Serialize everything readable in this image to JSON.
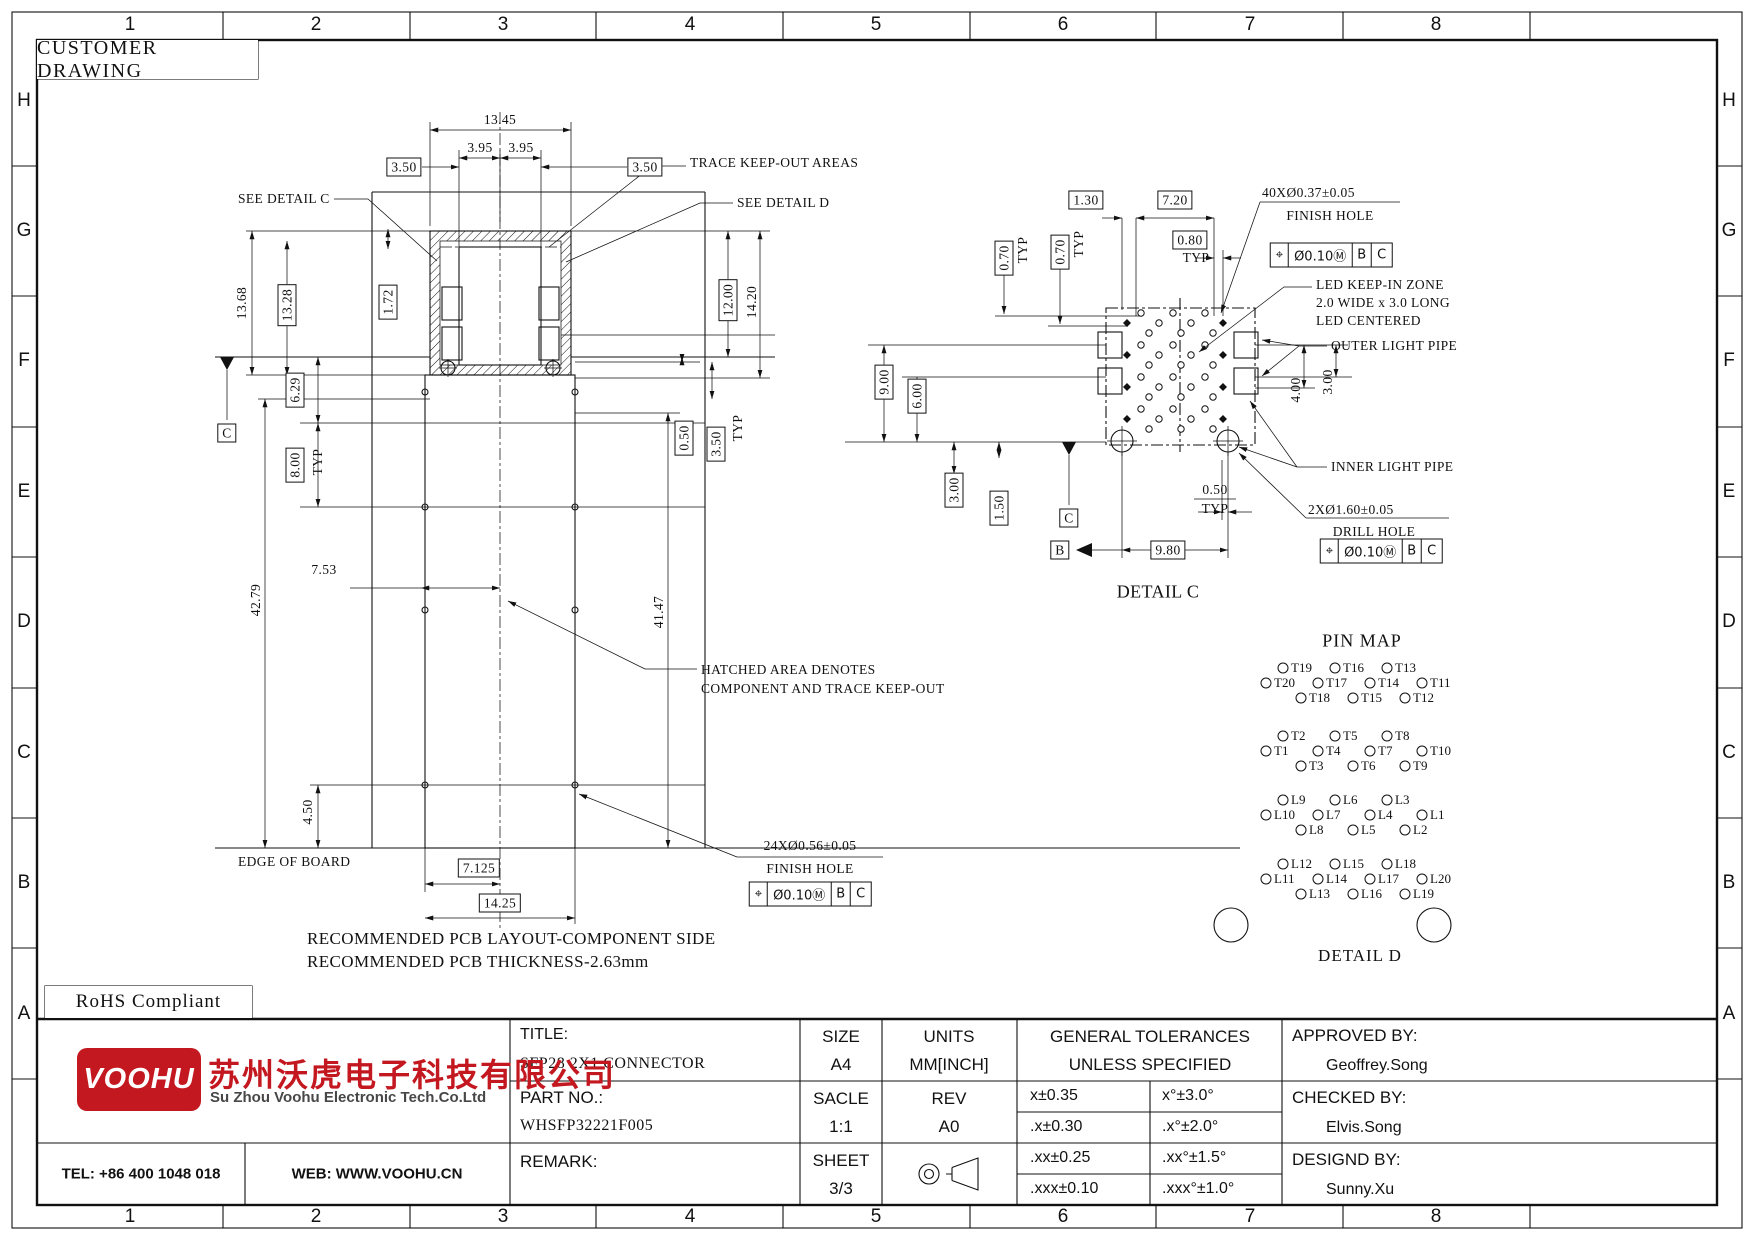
{
  "boxes": {
    "customer_drawing": "CUSTOMER DRAWING",
    "rohs": "RoHS Compliant"
  },
  "border": {
    "columns": [
      "1",
      "2",
      "3",
      "4",
      "5",
      "6",
      "7",
      "8"
    ],
    "rows": [
      "H",
      "G",
      "F",
      "E",
      "D",
      "C",
      "B",
      "A"
    ]
  },
  "pin_map": {
    "title": "PIN MAP",
    "detail_label": "DETAIL D",
    "groups": [
      {
        "rows": [
          [
            "T19",
            "T16",
            "T13"
          ],
          [
            "T20",
            "T17",
            "T14",
            "T11"
          ],
          [
            "T18",
            "T15",
            "T12"
          ]
        ]
      },
      {
        "rows": [
          [
            "T2",
            "T5",
            "T8"
          ],
          [
            "T1",
            "T4",
            "T7",
            "T10"
          ],
          [
            "T3",
            "T6",
            "T9"
          ]
        ]
      },
      {
        "rows": [
          [
            "L9",
            "L6",
            "L3"
          ],
          [
            "L10",
            "L7",
            "L4",
            "L1"
          ],
          [
            "L8",
            "L5",
            "L2"
          ]
        ]
      },
      {
        "rows": [
          [
            "L12",
            "L15",
            "L18"
          ],
          [
            "L11",
            "L14",
            "L17",
            "L20"
          ],
          [
            "L13",
            "L16",
            "L19"
          ]
        ]
      }
    ]
  },
  "gdt_frames": [
    {
      "x": 810,
      "y": 894,
      "cells": [
        "⌖",
        "Ø0.10Ⓜ",
        "B",
        "C"
      ]
    },
    {
      "x": 1331,
      "y": 255,
      "cells": [
        "⌖",
        "Ø0.10Ⓜ",
        "B",
        "C"
      ]
    },
    {
      "x": 1381,
      "y": 551,
      "cells": [
        "⌖",
        "Ø0.10Ⓜ",
        "B",
        "C"
      ]
    }
  ],
  "annotations": [
    {
      "t": "13.45",
      "x": 500,
      "y": 120
    },
    {
      "t": "3.95",
      "x": 480,
      "y": 148
    },
    {
      "t": "3.95",
      "x": 521,
      "y": 148
    },
    {
      "t": "3.50",
      "x": 404,
      "y": 167,
      "box": 1
    },
    {
      "t": "3.50",
      "x": 645,
      "y": 167,
      "box": 1
    },
    {
      "t": "TRACE KEEP-OUT AREAS",
      "x": 690,
      "y": 163,
      "al": 1,
      "n": "note-trace-keepout"
    },
    {
      "t": "SEE DETAIL C",
      "x": 238,
      "y": 199,
      "al": 1,
      "n": "note-see-detail-c"
    },
    {
      "t": "SEE DETAIL D",
      "x": 737,
      "y": 203,
      "al": 1,
      "n": "note-see-detail-d"
    },
    {
      "t": "13.68",
      "x": 242,
      "y": 303,
      "rot": 1
    },
    {
      "t": "13.28",
      "x": 287,
      "y": 305,
      "rot": 1,
      "box": 1
    },
    {
      "t": "1.72",
      "x": 388,
      "y": 302,
      "rot": 1,
      "box": 1
    },
    {
      "t": "12.00",
      "x": 728,
      "y": 300,
      "rot": 1,
      "box": 1
    },
    {
      "t": "14.20",
      "x": 752,
      "y": 302,
      "rot": 1
    },
    {
      "t": "6.29",
      "x": 295,
      "y": 390,
      "rot": 1,
      "box": 1
    },
    {
      "t": "8.00",
      "x": 295,
      "y": 465,
      "rot": 1,
      "box": 1
    },
    {
      "t": "TYP",
      "x": 318,
      "y": 462,
      "rot": 1
    },
    {
      "t": "0.50",
      "x": 684,
      "y": 438,
      "rot": 1,
      "box": 1
    },
    {
      "t": "3.50",
      "x": 716,
      "y": 444,
      "rot": 1,
      "box": 1
    },
    {
      "t": "TYP",
      "x": 738,
      "y": 428,
      "rot": 1
    },
    {
      "t": "42.79",
      "x": 256,
      "y": 600,
      "rot": 1
    },
    {
      "t": "7.53",
      "x": 324,
      "y": 570
    },
    {
      "t": "41.47",
      "x": 659,
      "y": 612,
      "rot": 1
    },
    {
      "t": "4.50",
      "x": 308,
      "y": 812,
      "rot": 1
    },
    {
      "t": "EDGE OF BOARD",
      "x": 238,
      "y": 862,
      "al": 1,
      "n": "note-edge-of-board"
    },
    {
      "t": "7.125",
      "x": 479,
      "y": 868,
      "box": 1
    },
    {
      "t": "14.25",
      "x": 500,
      "y": 903,
      "box": 1
    },
    {
      "t": "HATCHED AREA DENOTES",
      "x": 701,
      "y": 670,
      "al": 1,
      "n": "note-hatched-area"
    },
    {
      "t": "COMPONENT AND TRACE KEEP-OUT",
      "x": 701,
      "y": 689,
      "al": 1
    },
    {
      "t": "24XØ0.56±0.05",
      "x": 810,
      "y": 846,
      "n": "callout-finish-hole-24x"
    },
    {
      "t": "FINISH HOLE",
      "x": 810,
      "y": 869
    },
    {
      "t": "RECOMMENDED PCB LAYOUT-COMPONENT SIDE",
      "x": 307,
      "y": 939,
      "al": 1,
      "fs": 17,
      "n": "note-pcb-layout"
    },
    {
      "t": "RECOMMENDED PCB THICKNESS-2.63mm",
      "x": 307,
      "y": 962,
      "al": 1,
      "fs": 17,
      "n": "note-pcb-thickness"
    },
    {
      "t": "C",
      "x": 227,
      "y": 433,
      "box": 1,
      "n": "datum-c"
    },
    {
      "t": "1.30",
      "x": 1086,
      "y": 200,
      "box": 1
    },
    {
      "t": "7.20",
      "x": 1175,
      "y": 200,
      "box": 1
    },
    {
      "t": "0.80",
      "x": 1190,
      "y": 240,
      "box": 1
    },
    {
      "t": "TYP",
      "x": 1196,
      "y": 258
    },
    {
      "t": "0.70",
      "x": 1004,
      "y": 258,
      "rot": 1,
      "box": 1
    },
    {
      "t": "TYP",
      "x": 1023,
      "y": 250,
      "rot": 1
    },
    {
      "t": "0.70",
      "x": 1060,
      "y": 252,
      "rot": 1,
      "box": 1
    },
    {
      "t": "TYP",
      "x": 1079,
      "y": 244,
      "rot": 1
    },
    {
      "t": "40XØ0.37±0.05",
      "x": 1262,
      "y": 193,
      "al": 1,
      "n": "callout-finish-hole-40x"
    },
    {
      "t": "FINISH HOLE",
      "x": 1330,
      "y": 216
    },
    {
      "t": "LED KEEP-IN ZONE",
      "x": 1316,
      "y": 285,
      "al": 1,
      "n": "note-led-keepin"
    },
    {
      "t": "2.0 WIDE x 3.0 LONG",
      "x": 1316,
      "y": 303,
      "al": 1
    },
    {
      "t": "LED CENTERED",
      "x": 1316,
      "y": 321,
      "al": 1
    },
    {
      "t": "OUTER LIGHT PIPE",
      "x": 1331,
      "y": 346,
      "al": 1,
      "n": "note-outer-light-pipe"
    },
    {
      "t": "9.00",
      "x": 884,
      "y": 382,
      "rot": 1,
      "box": 1
    },
    {
      "t": "6.00",
      "x": 917,
      "y": 396,
      "rot": 1,
      "box": 1
    },
    {
      "t": "4.00",
      "x": 1296,
      "y": 390,
      "rot": 1
    },
    {
      "t": "3.00",
      "x": 1328,
      "y": 382,
      "rot": 1
    },
    {
      "t": "3.00",
      "x": 954,
      "y": 490,
      "rot": 1,
      "box": 1
    },
    {
      "t": "1.50",
      "x": 999,
      "y": 508,
      "rot": 1,
      "box": 1
    },
    {
      "t": "C",
      "x": 1069,
      "y": 518,
      "box": 1,
      "n": "datum-c-detail"
    },
    {
      "t": "B",
      "x": 1060,
      "y": 550,
      "box": 1,
      "n": "datum-b"
    },
    {
      "t": "9.80",
      "x": 1168,
      "y": 550,
      "box": 1
    },
    {
      "t": "0.50",
      "x": 1215,
      "y": 490
    },
    {
      "t": "TYP",
      "x": 1215,
      "y": 509
    },
    {
      "t": "INNER LIGHT PIPE",
      "x": 1331,
      "y": 467,
      "al": 1,
      "n": "note-inner-light-pipe"
    },
    {
      "t": "2XØ1.60±0.05",
      "x": 1308,
      "y": 510,
      "al": 1,
      "n": "callout-drill-hole-2x"
    },
    {
      "t": "DRILL HOLE",
      "x": 1374,
      "y": 532
    },
    {
      "t": "DETAIL C",
      "x": 1158,
      "y": 592,
      "fs": 18,
      "n": "detail-c-label"
    }
  ],
  "title_block": {
    "title_label": "TITLE:",
    "title": "SFP28 2X1 CONNECTOR",
    "size_label": "SIZE",
    "size": "A4",
    "units_label": "UNITS",
    "units": "MM[INCH]",
    "tol_header1": "GENERAL TOLERANCES",
    "tol_header2": "UNLESS SPECIFIED",
    "approved_label": "APPROVED BY:",
    "approved": "Geoffrey.Song",
    "part_label": "PART NO.:",
    "part": "WHSFP32221F005",
    "scale_label": "SACLE",
    "scale": "1:1",
    "rev_label": "REV",
    "rev": "A0",
    "checked_label": "CHECKED BY:",
    "checked": "Elvis.Song",
    "remark_label": "REMARK:",
    "sheet_label": "SHEET",
    "sheet": "3/3",
    "designed_label": "DESIGND BY:",
    "designed": "Sunny.Xu",
    "tolerances": [
      [
        "x±0.35",
        "x°±3.0°"
      ],
      [
        ".x±0.30",
        ".x°±2.0°"
      ],
      [
        ".xx±0.25",
        ".xx°±1.5°"
      ],
      [
        ".xxx±0.10",
        ".xxx°±1.0°"
      ]
    ],
    "tel": "TEL: +86 400 1048 018",
    "web": "WEB: WWW.VOOHU.CN"
  },
  "logo": {
    "wordmark": "VOOHU",
    "company_cn": "苏州沃虎电子科技有限公司",
    "company_en": "Su Zhou Voohu Electronic Tech.Co.Ltd",
    "brand_red": "#c41820"
  }
}
